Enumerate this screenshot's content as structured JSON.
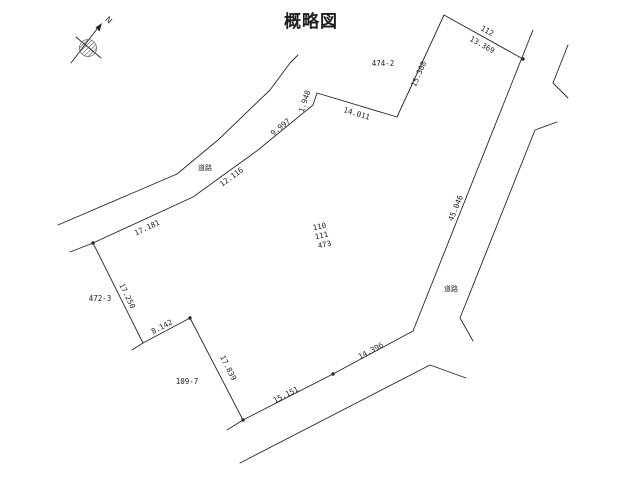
{
  "title": "概略図",
  "compass": {
    "north_label": "N"
  },
  "line_color": "#262626",
  "labels": [
    {
      "kind": "parcel-id",
      "name": "parcel-label-112",
      "text": "112",
      "x": 486,
      "y": 33,
      "rot": 29
    },
    {
      "kind": "parcel-id",
      "name": "parcel-label-474-2",
      "text": "474-2",
      "x": 383,
      "y": 66,
      "rot": 0
    },
    {
      "kind": "parcel-id",
      "name": "parcel-label-472-3",
      "text": "472-3",
      "x": 100,
      "y": 301,
      "rot": 0
    },
    {
      "kind": "parcel-id",
      "name": "parcel-label-109-7",
      "text": "109-7",
      "x": 187,
      "y": 384,
      "rot": 0
    },
    {
      "kind": "parcel-id",
      "name": "subject-parcel-number-110",
      "text": "110",
      "x": 320,
      "y": 229,
      "rot": -12
    },
    {
      "kind": "parcel-id",
      "name": "subject-parcel-number-111",
      "text": "111",
      "x": 322,
      "y": 238,
      "rot": -12
    },
    {
      "kind": "parcel-id",
      "name": "subject-parcel-number-473",
      "text": "473",
      "x": 325,
      "y": 247,
      "rot": -12
    },
    {
      "kind": "measurement",
      "name": "measure-13-369",
      "text": "13.369",
      "x": 481,
      "y": 47,
      "rot": 29
    },
    {
      "kind": "measurement",
      "name": "measure-15-308",
      "text": "15.308",
      "x": 421,
      "y": 75,
      "rot": -66
    },
    {
      "kind": "measurement",
      "name": "measure-14-011",
      "text": "14.011",
      "x": 356,
      "y": 116,
      "rot": 17
    },
    {
      "kind": "measurement",
      "name": "measure-1-948",
      "text": "1.948",
      "x": 307,
      "y": 102,
      "rot": -72
    },
    {
      "kind": "measurement",
      "name": "measure-9-997",
      "text": "9.997",
      "x": 282,
      "y": 129,
      "rot": -39
    },
    {
      "kind": "measurement",
      "name": "measure-12-116",
      "text": "12.116",
      "x": 233,
      "y": 179,
      "rot": -36
    },
    {
      "kind": "measurement",
      "name": "measure-17-181",
      "text": "17.181",
      "x": 148,
      "y": 230,
      "rot": -25
    },
    {
      "kind": "measurement",
      "name": "measure-17-250",
      "text": "17.250",
      "x": 125,
      "y": 297,
      "rot": 64
    },
    {
      "kind": "measurement",
      "name": "measure-8-142",
      "text": "8.142",
      "x": 163,
      "y": 329,
      "rot": -28
    },
    {
      "kind": "measurement",
      "name": "measure-17-839",
      "text": "17.839",
      "x": 226,
      "y": 369,
      "rot": 63
    },
    {
      "kind": "measurement",
      "name": "measure-15-151",
      "text": "15.151",
      "x": 287,
      "y": 397,
      "rot": -27
    },
    {
      "kind": "measurement",
      "name": "measure-14-396",
      "text": "14.396",
      "x": 372,
      "y": 353,
      "rot": -28
    },
    {
      "kind": "measurement",
      "name": "measure-45-046",
      "text": "45.046",
      "x": 458,
      "y": 209,
      "rot": -68
    },
    {
      "kind": "road-label",
      "name": "road-label-northwest",
      "text": "道路",
      "x": 205,
      "y": 170,
      "rot": 0
    },
    {
      "kind": "road-label",
      "name": "road-label-east",
      "text": "道路",
      "x": 451,
      "y": 291,
      "rot": 0
    }
  ],
  "drawing": {
    "lines": [
      {
        "name": "nw-road-outer-edge",
        "points": [
          [
            58,
            225
          ],
          [
            177,
            174
          ],
          [
            218,
            140
          ],
          [
            270,
            90
          ],
          [
            290,
            63
          ],
          [
            298,
            55
          ]
        ]
      },
      {
        "name": "north-boundary-along-road",
        "points": [
          [
            70,
            252
          ],
          [
            93,
            243
          ],
          [
            193,
            197
          ],
          [
            258,
            150
          ],
          [
            313,
            105
          ],
          [
            317,
            93
          ],
          [
            397,
            117
          ],
          [
            444,
            15
          ],
          [
            523,
            59
          ]
        ]
      },
      {
        "name": "east-road-left-edge",
        "points": [
          [
            533,
            30
          ],
          [
            413,
            331
          ]
        ]
      },
      {
        "name": "east-road-right-edge-upper",
        "points": [
          [
            568,
            45
          ],
          [
            553,
            83
          ],
          [
            568,
            98
          ]
        ]
      },
      {
        "name": "east-road-right-edge-lower",
        "points": [
          [
            557,
            122
          ],
          [
            535,
            130
          ],
          [
            460,
            318
          ],
          [
            473,
            341
          ]
        ]
      },
      {
        "name": "south-boundary",
        "points": [
          [
            243,
            420
          ],
          [
            333,
            374
          ],
          [
            413,
            331
          ]
        ]
      },
      {
        "name": "west-boundary",
        "points": [
          [
            93,
            243
          ],
          [
            143,
            343
          ],
          [
            190,
            318
          ],
          [
            243,
            420
          ]
        ]
      },
      {
        "name": "west-corner-spur",
        "points": [
          [
            143,
            343
          ],
          [
            132,
            350
          ]
        ]
      },
      {
        "name": "south-corner-spur",
        "points": [
          [
            243,
            420
          ],
          [
            227,
            430
          ]
        ]
      },
      {
        "name": "south-road-outer-edge",
        "points": [
          [
            240,
            463
          ],
          [
            430,
            365
          ],
          [
            466,
            378
          ]
        ]
      }
    ],
    "dots": [
      [
        93,
        243
      ],
      [
        190,
        318
      ],
      [
        243,
        420
      ],
      [
        333,
        374
      ],
      [
        523,
        59
      ]
    ]
  }
}
